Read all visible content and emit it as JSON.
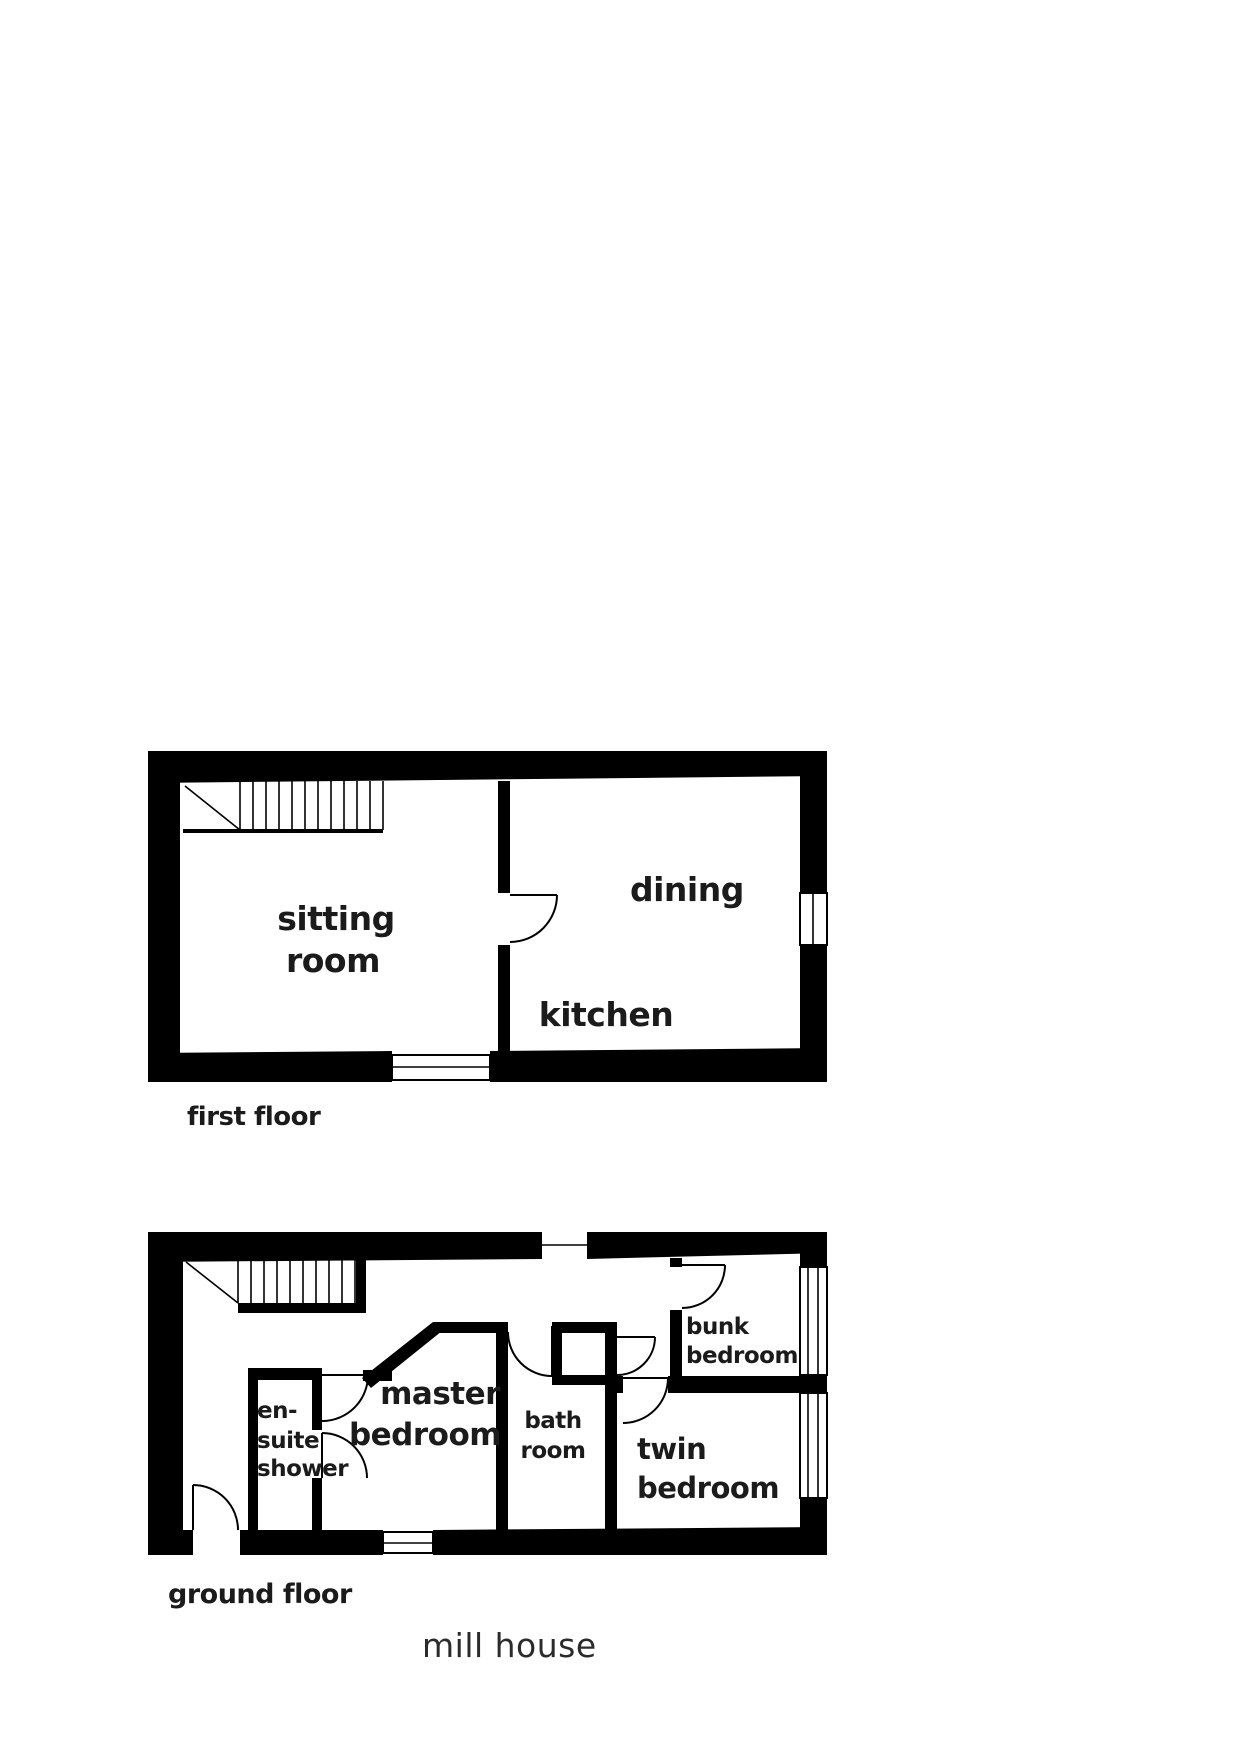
{
  "title": "mill house",
  "colors": {
    "wall": "#000000",
    "text": "#1b1b1b",
    "background": "#ffffff"
  },
  "plans": {
    "first_floor": {
      "caption": "first floor",
      "rooms": {
        "sitting_room": {
          "line1": "sitting",
          "line2": "room"
        },
        "dining": {
          "line1": "dining"
        },
        "kitchen": {
          "line1": "kitchen"
        }
      }
    },
    "ground_floor": {
      "caption": "ground floor",
      "rooms": {
        "en_suite_shower": {
          "line1": "en-",
          "line2": "suite",
          "line3": "shower"
        },
        "master_bedroom": {
          "line1": "master",
          "line2": "bedroom"
        },
        "bath_room": {
          "line1": "bath",
          "line2": "room"
        },
        "twin_bedroom": {
          "line1": "twin",
          "line2": "bedroom"
        },
        "bunk_bedroom": {
          "line1": "bunk",
          "line2": "bedroom"
        }
      }
    }
  }
}
